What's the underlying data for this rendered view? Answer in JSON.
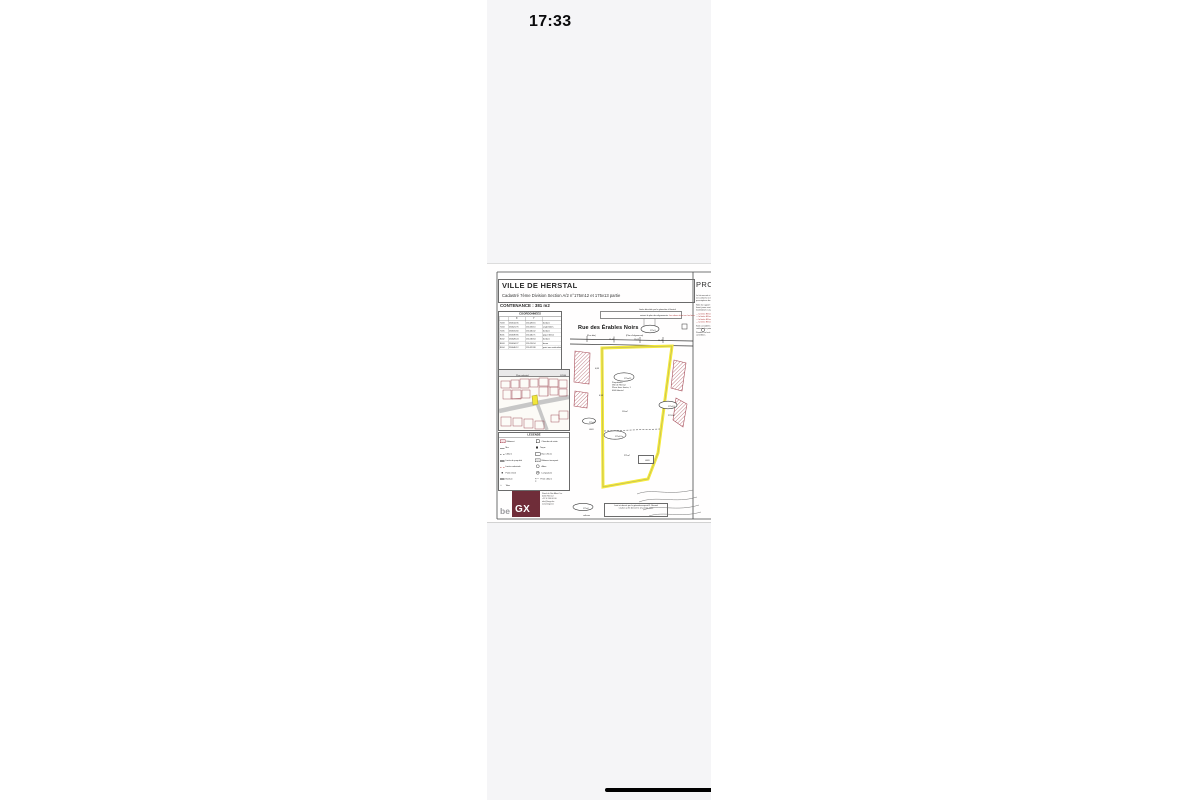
{
  "status_bar": {
    "time": "17:33"
  },
  "document": {
    "title_block": {
      "city": "VILLE DE HERSTAL",
      "subtitle": "Cadastré 7ème Division Section A/2   n°175m12 et 175v13 partie",
      "contenance": "CONTENANCE : 381 m2"
    },
    "project_label": "PROJET",
    "survey_note": {
      "line1": "Limite décrétée par le géomètre à Herstal",
      "line2a": "suivant le plan des alignements.",
      "line2b": "Les arbres étant sur les lieux."
    },
    "coordinates": {
      "title": "COORDONNEES",
      "col_x": "X",
      "col_y": "Y",
      "rows": [
        {
          "id": "7003",
          "x": "234614.35",
          "y": "151428.16",
          "remark": "bordure"
        },
        {
          "id": "7004",
          "x": "234621.76",
          "y": "151433.10",
          "remark": "angle bâtim."
        },
        {
          "id": "7005",
          "x": "234631.60",
          "y": "151440.42",
          "remark": "bordure"
        },
        {
          "id": "8001",
          "x": "234639.85",
          "y": "151446.71",
          "remark": "piquet béton"
        },
        {
          "id": "8002",
          "x": "234628.24",
          "y": "151418.64",
          "remark": "bordure"
        },
        {
          "id": "8003",
          "x": "234634.27",
          "y": "151413.94",
          "remark": "borne"
        },
        {
          "id": "8004",
          "x": "234646.12",
          "y": "151422.88",
          "remark": "point non matérialisé"
        }
      ]
    },
    "street": {
      "name": "Rue des Érables Noirs",
      "sub_left": "(Rue dite)",
      "sub_right": "(Plan d'alignement)"
    },
    "road_dimensions": [
      "15,45",
      "19,05",
      "14,22"
    ],
    "road_parcel_label": "175c3",
    "parcel": {
      "label": "175m12",
      "owner_lines": [
        "Propriétaire:",
        "Ville de Herstal",
        "Place Jean Jaurès, 1",
        "4040  Herstal"
      ],
      "area_top": "110m²",
      "label_lower": "175v13 p",
      "area_lower": "271m²",
      "ref_box": "L683"
    },
    "right_parcel": {
      "label": "175v13",
      "area": "2797m²"
    },
    "left_labels": {
      "ellipse": "175g2",
      "ref": "L663",
      "dim1": "4,88",
      "dim2": "6,98"
    },
    "bottom_labels": {
      "ellipse": "175a2",
      "sub": "cultures"
    },
    "bottom_note": {
      "line1": "Levé et dressé par le géomètre-expert R. Renard",
      "line2": "Le plan a été dressé le 12 janvier 2022"
    },
    "inset": {
      "title": "Plan cadastral",
      "scale": "1/2500"
    },
    "legend": {
      "title": "LEGENDE",
      "left": [
        {
          "label": "Bâtiment"
        },
        {
          "label": "Mur"
        },
        {
          "label": "Clôture"
        },
        {
          "label": "Limite de propriété"
        },
        {
          "label": "Limite cadastrale"
        },
        {
          "label": "Point relevé"
        },
        {
          "label": "Bordure"
        },
        {
          "label": "Talus"
        }
      ],
      "right": [
        {
          "label": "Chambre de visite"
        },
        {
          "label": "Taque"
        },
        {
          "label": "Bac à fleurs"
        },
        {
          "label": "Bâtiment incorporé"
        },
        {
          "label": "Arbre"
        },
        {
          "label": "Lampadaire"
        },
        {
          "label": "Fil de clôture"
        }
      ]
    },
    "logo": {
      "prefix": "be",
      "mark": "GX",
      "contact_lines": [
        "Rond du Roi Albert 1er",
        "4040 Herstal",
        "+32 4 240 00 00",
        "info@begx.be",
        "www.begx.be"
      ]
    },
    "right_notes": [
      "Le lot mesuré et représenté au présent plan est conforme à l'état des lieux et satisfait aux prescriptions de qualité des mesurages.",
      "Note du rapport : les limites indiquées d'un liseré jaune sont garanties. Les points sont matérialisés sur place.",
      "— la limite EB est définie",
      "— la limite EB est reprise",
      "— la limite EB est bornée",
      "— la limite EB est décrite",
      "Sont considérés comme repris et valeur du cadastre les points ci-dessus.",
      "Pendant ce levé les mesures ont été contrôlées."
    ],
    "colors": {
      "highlight_yellow": "#f4e93a",
      "hatch_maroon": "#a84e5a",
      "logo_maroon": "#6f2d39"
    }
  }
}
